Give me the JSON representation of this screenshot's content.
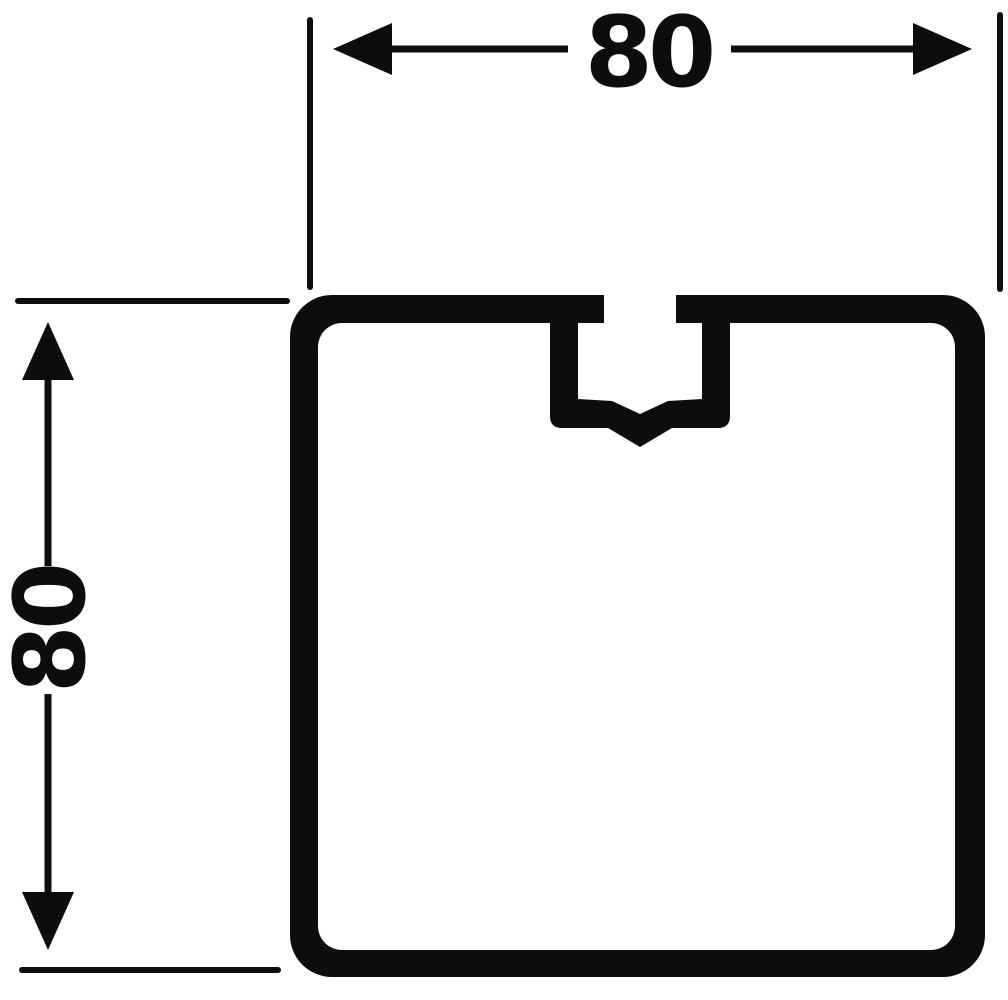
{
  "drawing": {
    "background_color": "#ffffff",
    "ink_color": "#0d0d0d",
    "subject": "square-profile-cross-section-with-top-slot",
    "horizontal_dimension": {
      "label": "80",
      "orientation": "horizontal"
    },
    "vertical_dimension": {
      "label": "80",
      "orientation": "vertical"
    }
  }
}
